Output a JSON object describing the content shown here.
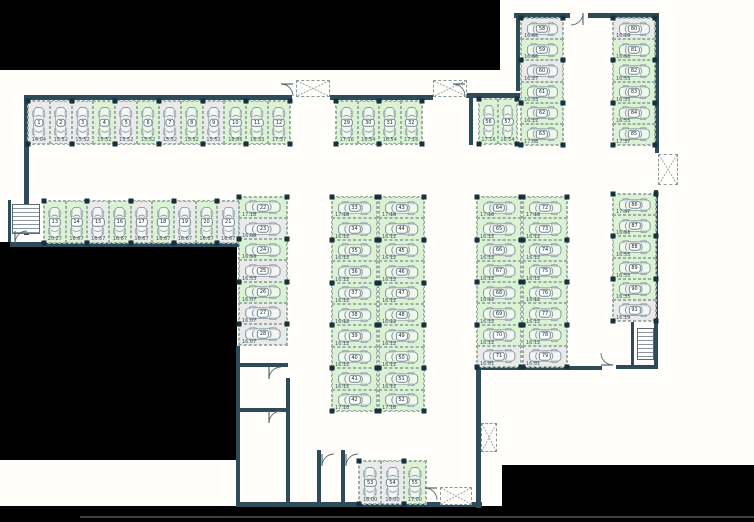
{
  "title": "parking-level-floor-plan",
  "colors": {
    "background": "#000000",
    "floor": "#fffefa",
    "wall": "#2d4b58",
    "stall_green": "#dcf2d4",
    "stall_gray": "#e9eae9",
    "marker": "#16323d"
  },
  "symbols": {
    "shaft": "x-box-icon",
    "stairs": "stairs-icon",
    "door": "door-swing-icon",
    "car": "car-top-view-icon"
  },
  "groups": {
    "row1": {
      "label": "stalls 1-12",
      "stalls": [
        {
          "n": "1",
          "m": "14.04",
          "s": "gray"
        },
        {
          "n": "2",
          "m": "15.52",
          "s": "gray"
        },
        {
          "n": "3",
          "m": "15.52",
          "s": "gray"
        },
        {
          "n": "4",
          "m": "15.52",
          "s": "green"
        },
        {
          "n": "5",
          "m": "15.52",
          "s": "gray"
        },
        {
          "n": "6",
          "m": "15.52",
          "s": "green"
        },
        {
          "n": "7",
          "m": "15.52",
          "s": "gray"
        },
        {
          "n": "8",
          "m": "15.52",
          "s": "green"
        },
        {
          "n": "9",
          "m": "15.52",
          "s": "gray"
        },
        {
          "n": "10",
          "m": "16.86",
          "s": "green"
        },
        {
          "n": "11",
          "m": "16.33",
          "s": "green"
        },
        {
          "n": "12",
          "m": "17.37",
          "s": "green"
        }
      ]
    },
    "row2": {
      "label": "stalls 13-21",
      "stalls": [
        {
          "n": "13",
          "m": "20.27",
          "s": "green"
        },
        {
          "n": "14",
          "m": "16.67",
          "s": "green"
        },
        {
          "n": "15",
          "m": "16.67",
          "s": "gray"
        },
        {
          "n": "16",
          "m": "16.67",
          "s": "green"
        },
        {
          "n": "17",
          "m": "16.67",
          "s": "gray"
        },
        {
          "n": "18",
          "m": "16.67",
          "s": "green"
        },
        {
          "n": "19",
          "m": "16.67",
          "s": "gray"
        },
        {
          "n": "20",
          "m": "16.67",
          "s": "green"
        },
        {
          "n": "21",
          "m": "16.67",
          "s": "gray"
        }
      ]
    },
    "col22": {
      "label": "stalls 22-28",
      "stalls": [
        {
          "n": "22",
          "m": "17.18",
          "s": "green"
        },
        {
          "n": "23",
          "m": "16.08",
          "s": "gray"
        },
        {
          "n": "24",
          "m": "16.53",
          "s": "green"
        },
        {
          "n": "25",
          "m": "16.53",
          "s": "gray"
        },
        {
          "n": "26",
          "m": "16.07",
          "s": "green"
        },
        {
          "n": "27",
          "m": "16.07",
          "s": "gray"
        },
        {
          "n": "28",
          "m": "16.07",
          "s": "gray"
        }
      ]
    },
    "row29": {
      "label": "stalls 29-32",
      "stalls": [
        {
          "n": "29",
          "m": "17.16",
          "s": "green"
        },
        {
          "n": "30",
          "m": "16.54",
          "s": "green"
        },
        {
          "n": "31",
          "m": "16.54",
          "s": "green"
        },
        {
          "n": "32",
          "m": "17.16",
          "s": "green"
        }
      ]
    },
    "blockCa": {
      "label": "stalls 33-42",
      "stalls": [
        {
          "n": "33",
          "m": "17.18",
          "s": "green"
        },
        {
          "n": "34",
          "m": "16.12",
          "s": "green"
        },
        {
          "n": "35",
          "m": "16.12",
          "s": "green"
        },
        {
          "n": "36",
          "m": "16.12",
          "s": "green"
        },
        {
          "n": "37",
          "m": "16.12",
          "s": "green"
        },
        {
          "n": "38",
          "m": "16.12",
          "s": "green"
        },
        {
          "n": "39",
          "m": "16.12",
          "s": "green"
        },
        {
          "n": "40",
          "m": "16.12",
          "s": "green"
        },
        {
          "n": "41",
          "m": "16.12",
          "s": "green"
        },
        {
          "n": "42",
          "m": "17.18",
          "s": "green"
        }
      ]
    },
    "blockCb": {
      "label": "stalls 43-52",
      "stalls": [
        {
          "n": "43",
          "m": "17.18",
          "s": "green"
        },
        {
          "n": "44",
          "m": "16.12",
          "s": "green"
        },
        {
          "n": "45",
          "m": "16.12",
          "s": "green"
        },
        {
          "n": "46",
          "m": "16.12",
          "s": "green"
        },
        {
          "n": "47",
          "m": "16.12",
          "s": "green"
        },
        {
          "n": "48",
          "m": "16.12",
          "s": "green"
        },
        {
          "n": "49",
          "m": "16.12",
          "s": "green"
        },
        {
          "n": "50",
          "m": "16.12",
          "s": "green"
        },
        {
          "n": "51",
          "m": "16.12",
          "s": "green"
        },
        {
          "n": "52",
          "m": "17.18",
          "s": "green"
        }
      ]
    },
    "row53": {
      "label": "stalls 53-55",
      "stalls": [
        {
          "n": "53",
          "m": "16.00",
          "s": "gray"
        },
        {
          "n": "54",
          "m": "16.00",
          "s": "gray"
        },
        {
          "n": "55",
          "m": "17.00",
          "s": "green"
        }
      ]
    },
    "pair56": {
      "label": "stalls 56-57",
      "stalls": [
        {
          "n": "56",
          "m": "17.16",
          "s": "green"
        },
        {
          "n": "57",
          "m": "16.54",
          "s": "green"
        }
      ]
    },
    "col58": {
      "label": "stalls 58-63",
      "stalls": [
        {
          "n": "58",
          "m": "16.65",
          "s": "gray"
        },
        {
          "n": "59",
          "m": "16.66",
          "s": "green"
        },
        {
          "n": "60",
          "m": "16.27",
          "s": "gray"
        },
        {
          "n": "61",
          "m": "16.33",
          "s": "green"
        },
        {
          "n": "62",
          "m": "16.12",
          "s": "green"
        },
        {
          "n": "63",
          "m": "17.08",
          "s": "green"
        }
      ]
    },
    "blockRa": {
      "label": "stalls 64-71",
      "stalls": [
        {
          "n": "64",
          "m": "17.10",
          "s": "green"
        },
        {
          "n": "65",
          "m": "16.12",
          "s": "green"
        },
        {
          "n": "66",
          "m": "16.12",
          "s": "green"
        },
        {
          "n": "67",
          "m": "16.12",
          "s": "green"
        },
        {
          "n": "68",
          "m": "16.12",
          "s": "green"
        },
        {
          "n": "69",
          "m": "16.12",
          "s": "green"
        },
        {
          "n": "70",
          "m": "16.12",
          "s": "green"
        },
        {
          "n": "71",
          "m": "16.81",
          "s": "gray"
        }
      ]
    },
    "blockRb": {
      "label": "stalls 72-79",
      "stalls": [
        {
          "n": "72",
          "m": "17.18",
          "s": "green"
        },
        {
          "n": "73",
          "m": "16.12",
          "s": "green"
        },
        {
          "n": "74",
          "m": "16.12",
          "s": "green"
        },
        {
          "n": "75",
          "m": "16.12",
          "s": "green"
        },
        {
          "n": "76",
          "m": "16.12",
          "s": "green"
        },
        {
          "n": "77",
          "m": "16.12",
          "s": "green"
        },
        {
          "n": "78",
          "m": "16.12",
          "s": "green"
        },
        {
          "n": "79",
          "m": "16.81",
          "s": "gray"
        }
      ]
    },
    "col80": {
      "label": "stalls 80-85",
      "stalls": [
        {
          "n": "80",
          "m": "16.19",
          "s": "gray"
        },
        {
          "n": "81",
          "m": "16.53",
          "s": "green"
        },
        {
          "n": "82",
          "m": "16.53",
          "s": "green"
        },
        {
          "n": "83",
          "m": "16.33",
          "s": "green"
        },
        {
          "n": "84",
          "m": "16.53",
          "s": "green"
        },
        {
          "n": "85",
          "m": "17.37",
          "s": "green"
        }
      ]
    },
    "col86": {
      "label": "stalls 86-91",
      "stalls": [
        {
          "n": "86",
          "m": "17.37",
          "s": "green"
        },
        {
          "n": "87",
          "m": "16.53",
          "s": "green"
        },
        {
          "n": "88",
          "m": "16.53",
          "s": "green"
        },
        {
          "n": "89",
          "m": "16.53",
          "s": "green"
        },
        {
          "n": "90",
          "m": "16.33",
          "s": "green"
        },
        {
          "n": "91",
          "m": "16.19",
          "s": "gray"
        }
      ]
    }
  }
}
